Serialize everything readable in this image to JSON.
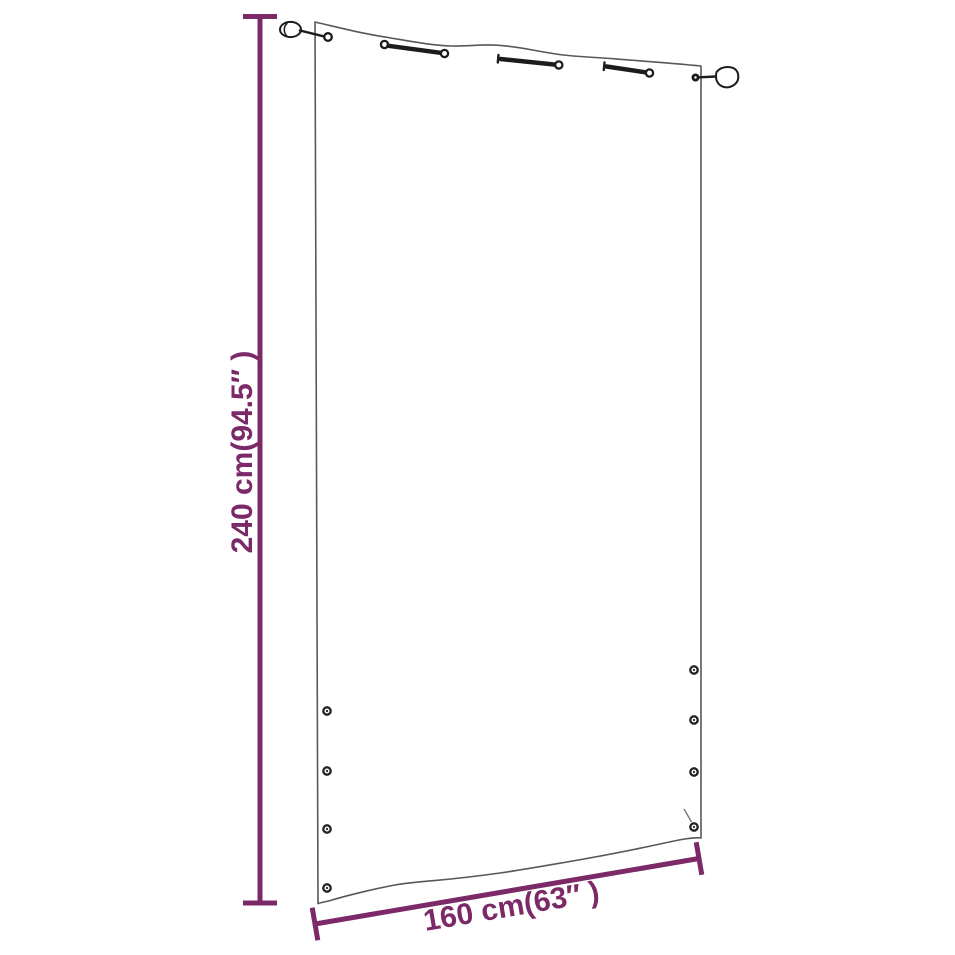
{
  "diagram": {
    "type": "product-dimension-diagram",
    "subject": "balcony-screen-outline",
    "height_dimension": {
      "label": "240 cm(94.5″ )",
      "value_cm": "240",
      "value_inches": "94.5"
    },
    "width_dimension": {
      "label": "160 cm(63″ )",
      "value_cm": "160",
      "value_inches": "63"
    },
    "colors": {
      "dimension_annotation": "#7c2968",
      "product_outline": "#585858",
      "hardware": "#1c1c1c",
      "background": "#ffffff"
    }
  }
}
